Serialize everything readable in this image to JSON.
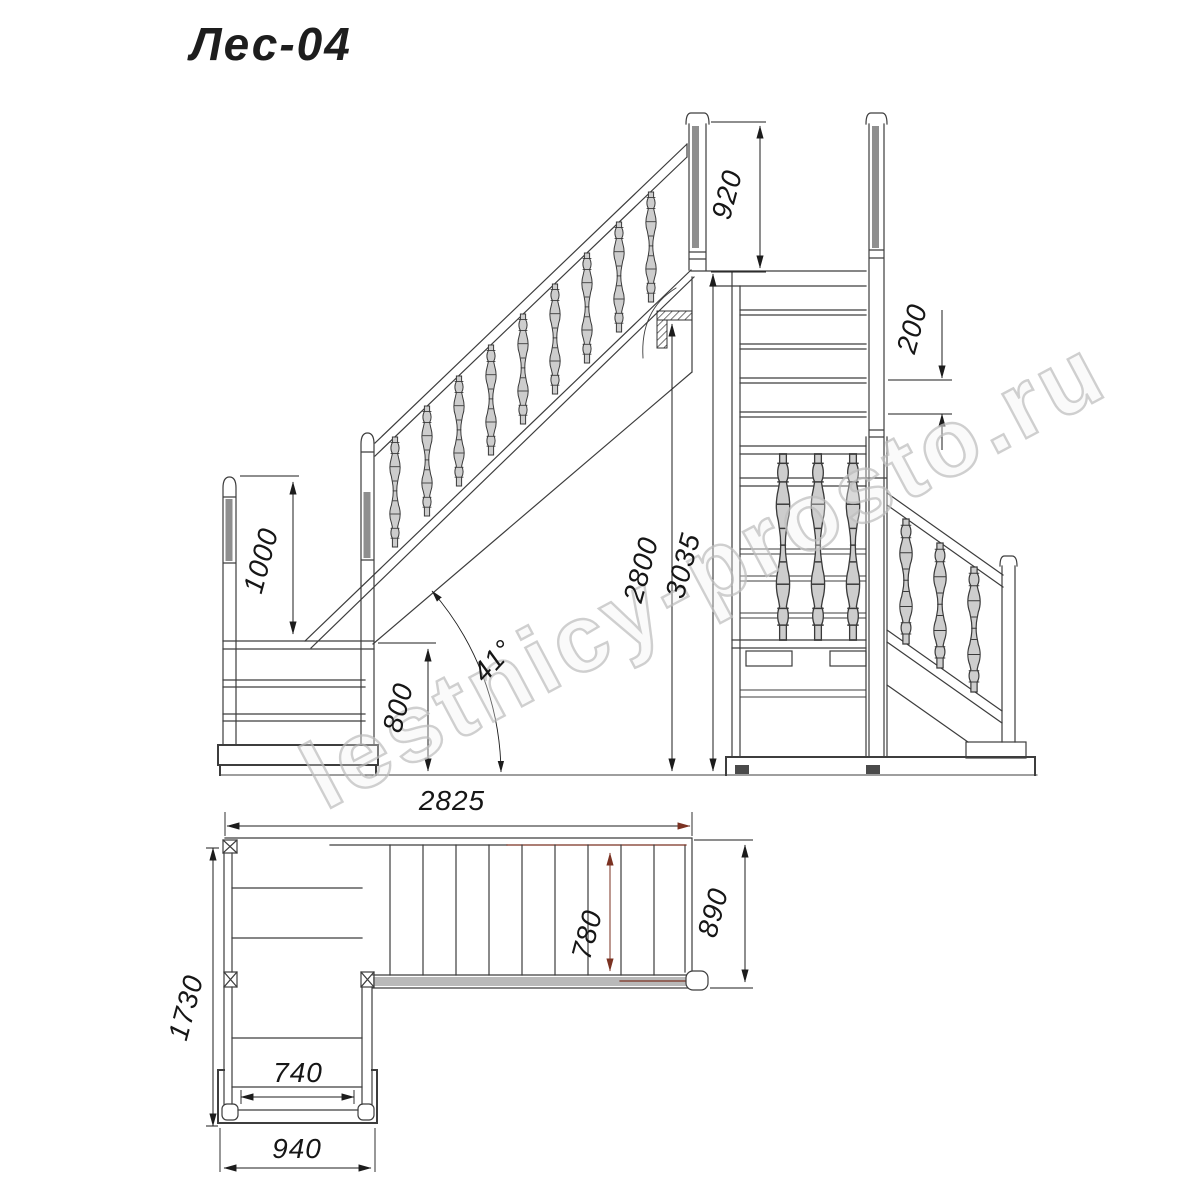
{
  "title": "Лес-04",
  "watermark": "lestnicy-prosto.ru",
  "dims": {
    "side": {
      "post_above_floor": "920",
      "guard_rail_height": "1000",
      "podium_height": "800",
      "floor_clearance": "2800",
      "total_height": "3035",
      "angle": "41°"
    },
    "rear": {
      "step_rise": "200"
    },
    "plan": {
      "total_length": "2825",
      "total_depth": "1730",
      "entry_clear_width": "740",
      "entry_width": "940",
      "flight_clear_width": "780",
      "flight_width": "890"
    }
  }
}
